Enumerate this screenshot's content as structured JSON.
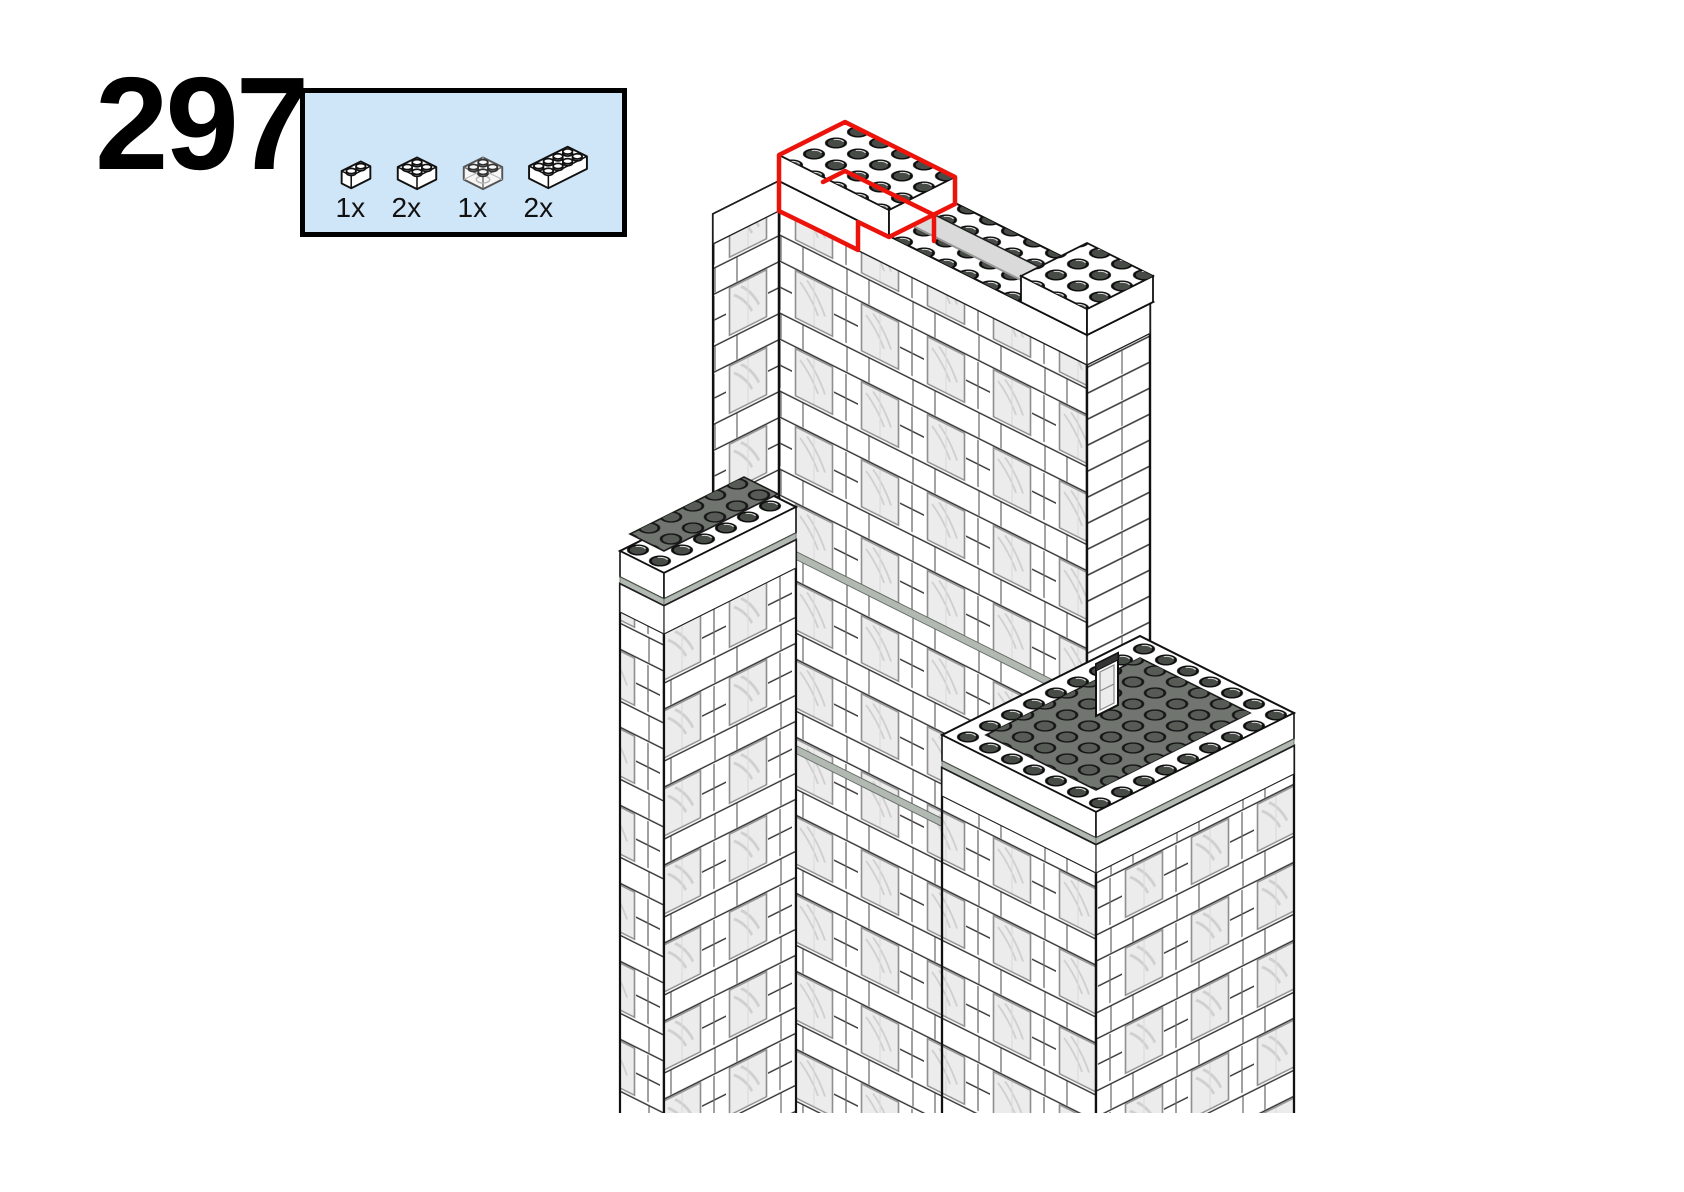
{
  "step": {
    "number": "297"
  },
  "parts_box": {
    "background": "#cfe6f8",
    "border_color": "#000000",
    "parts": [
      {
        "id": "brick-1x2-white",
        "qty": "1x"
      },
      {
        "id": "brick-2x2-white",
        "qty": "2x"
      },
      {
        "id": "brick-2x2-trans-clear",
        "qty": "1x"
      },
      {
        "id": "brick-2x4-white",
        "qty": "2x"
      }
    ]
  },
  "illustration": {
    "subject": "Isometric LEGO skyscraper tower under construction; new bricks on the top parapet outlined in red",
    "highlight_color": "#ec130b",
    "wall_color": "#ffffff",
    "window_color": "#ececec",
    "deck_color": "#70756f",
    "ledge_color": "#b2b8b2",
    "outline_color": "#111111"
  }
}
